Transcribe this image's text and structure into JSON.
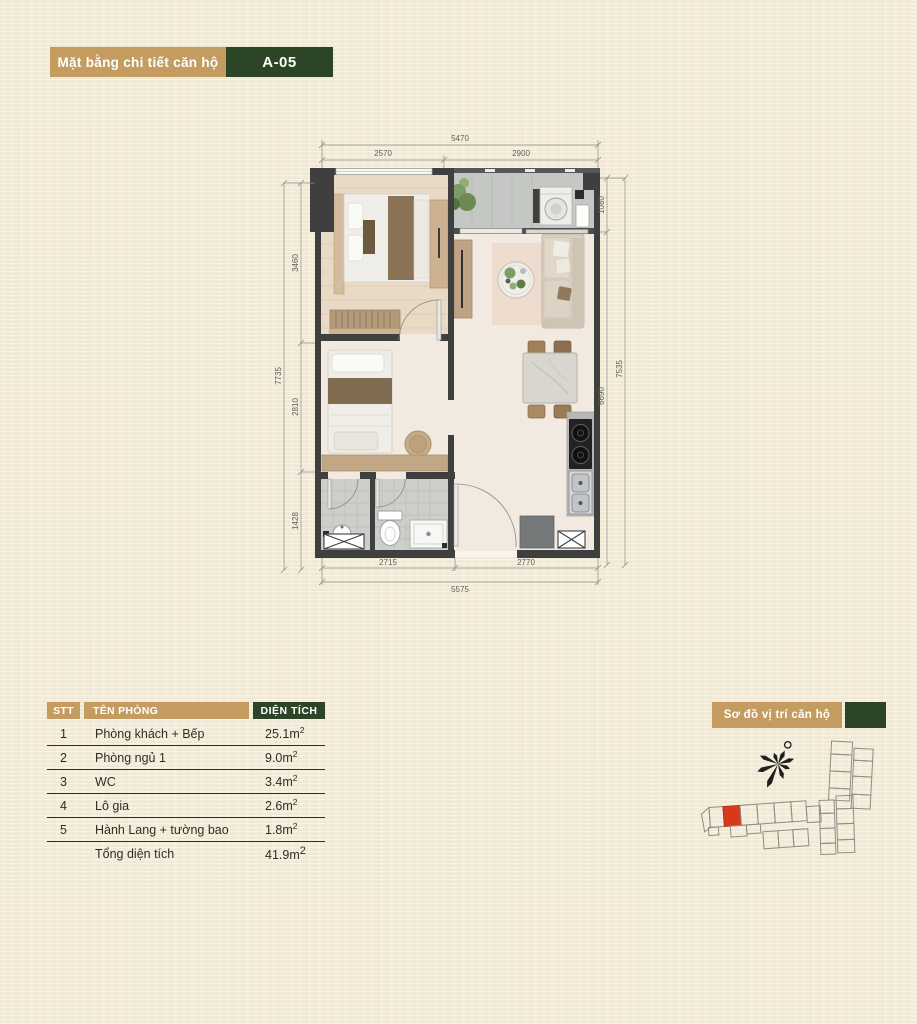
{
  "page": {
    "background": "#f2ebd9"
  },
  "colors": {
    "tan": "#c59c60",
    "dark_green": "#2d4527",
    "wall": "#3f3f3f",
    "highlight_red": "#d8391d"
  },
  "header": {
    "title": "Mặt bằng chi tiết căn hộ",
    "unit_code": "A-05"
  },
  "floorplan": {
    "dims": {
      "top_overall": "5470",
      "top_left": "2570",
      "top_right": "2900",
      "left_overall": "7735",
      "left_1": "3460",
      "left_2": "2810",
      "left_3": "1428",
      "right_overall": "7535",
      "right_1": "1080",
      "right_2": "6690",
      "bottom_overall": "5575",
      "bottom_left": "2715",
      "bottom_right": "2770"
    }
  },
  "area_table": {
    "col_stt": "STT",
    "col_room": "TÊN PHÒNG",
    "col_area": "DIỆN TÍCH",
    "rows": [
      {
        "stt": "1",
        "room": "Phòng khách + Bếp",
        "area": "25.1m",
        "sup": "2"
      },
      {
        "stt": "2",
        "room": "Phòng ngủ 1",
        "area": "9.0m",
        "sup": "2"
      },
      {
        "stt": "3",
        "room": "WC",
        "area": "3.4m",
        "sup": "2"
      },
      {
        "stt": "4",
        "room": "Lô gia",
        "area": "2.6m",
        "sup": "2"
      },
      {
        "stt": "5",
        "room": "Hành Lang + tường bao",
        "area": "1.8m",
        "sup": "2"
      }
    ],
    "total": {
      "label": "Tổng diện tích",
      "area": "41.9m",
      "sup": "2"
    }
  },
  "location": {
    "title": "Sơ đồ vị trí căn hộ"
  }
}
